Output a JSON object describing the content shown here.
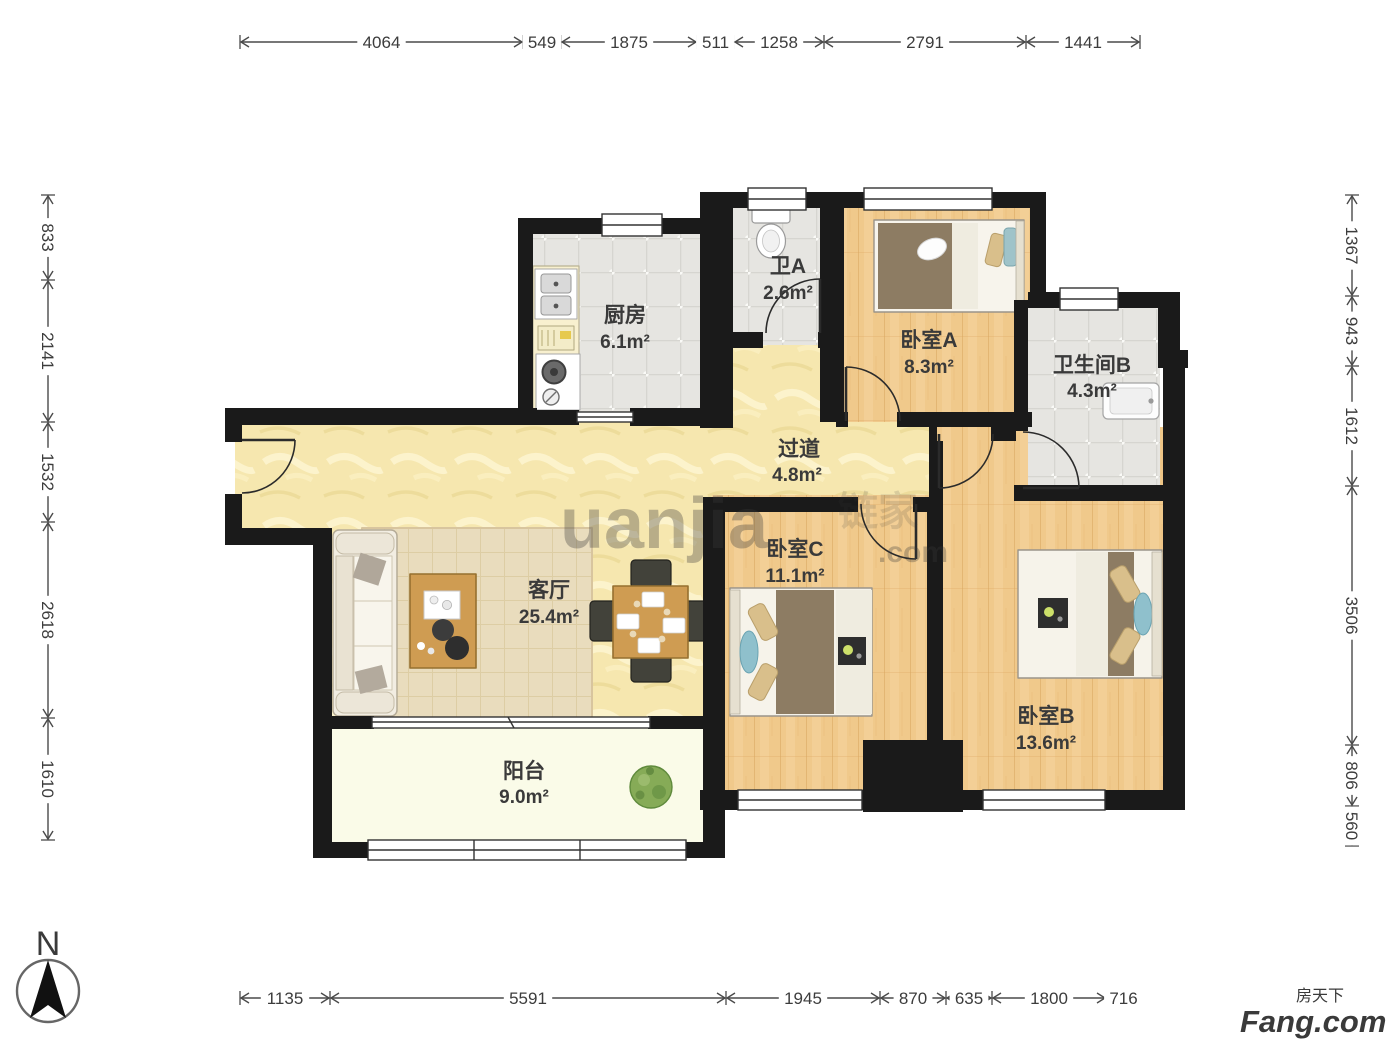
{
  "plan": {
    "rooms": [
      {
        "id": "kitchen",
        "name": "厨房",
        "area": "6.1m²"
      },
      {
        "id": "bath-a",
        "name": "卫A",
        "area": "2.6m²"
      },
      {
        "id": "bedroom-a",
        "name": "卧室A",
        "area": "8.3m²"
      },
      {
        "id": "bath-b",
        "name": "卫生间B",
        "area": "4.3m²"
      },
      {
        "id": "hallway",
        "name": "过道",
        "area": "4.8m²"
      },
      {
        "id": "living-room",
        "name": "客厅",
        "area": "25.4m²"
      },
      {
        "id": "bedroom-c",
        "name": "卧室C",
        "area": "11.1m²"
      },
      {
        "id": "bedroom-b",
        "name": "卧室B",
        "area": "13.6m²"
      },
      {
        "id": "balcony",
        "name": "阳台",
        "area": "9.0m²"
      }
    ],
    "compass_label": "N",
    "watermarks": {
      "center_a": "uanjia",
      "center_b": "链家",
      "center_c": ".com",
      "bottom_right_line1": "房天下",
      "bottom_right_line2": "Fang.com"
    }
  },
  "dimensions_mm": {
    "top": [
      "4064",
      "549",
      "1875",
      "511",
      "1258",
      "2791",
      "1441"
    ],
    "left": [
      "833",
      "2141",
      "1532",
      "2618",
      "1610"
    ],
    "right": [
      "1367",
      "943",
      "1612",
      "3506",
      "806",
      "560"
    ],
    "bottom": [
      "1135",
      "5591",
      "1945",
      "870",
      "635",
      "1800",
      "716"
    ]
  },
  "colors": {
    "wall": "#1a1a1a",
    "wood_floor": "#f0c98b",
    "marble_floor": "#f6e7af",
    "tile_floor": "#e6e5e1",
    "balcony_floor": "#fafbe8",
    "label_text": "#3a3a3a",
    "dimension_line": "#4a4a4a"
  }
}
